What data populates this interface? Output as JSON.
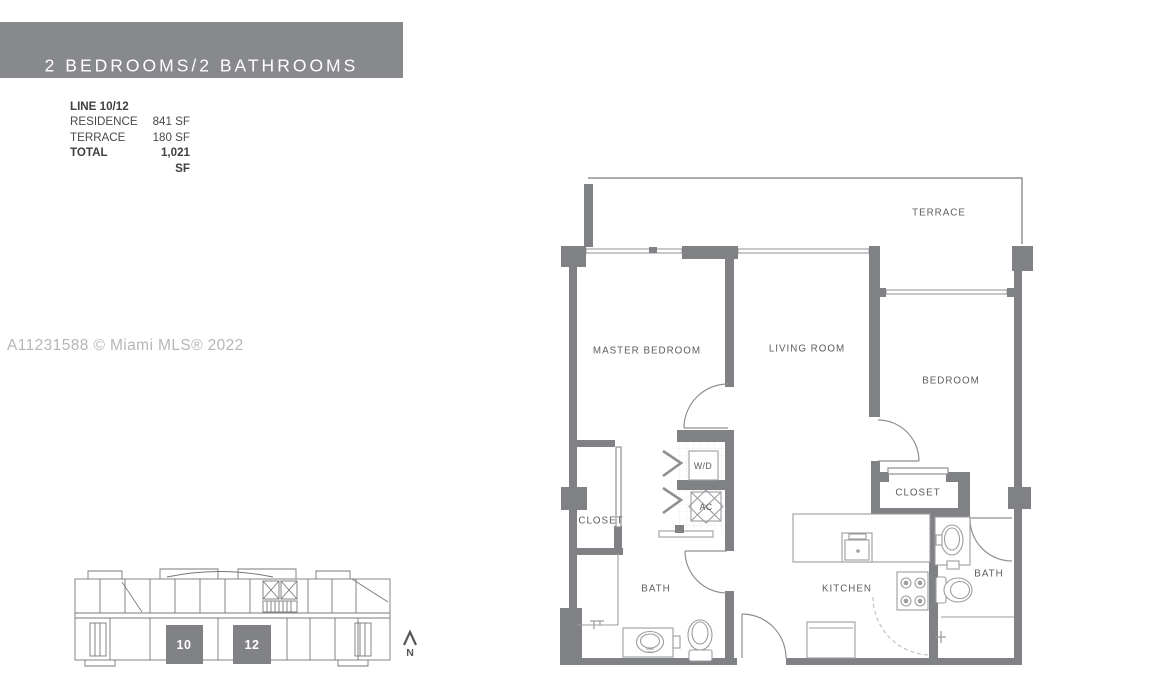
{
  "banner": {
    "title": "2 BEDROOMS/2 BATHROOMS"
  },
  "stats": {
    "line": "LINE 10/12",
    "rows": [
      {
        "label": "RESIDENCE",
        "value": "841 SF"
      },
      {
        "label": "TERRACE",
        "value": "180 SF"
      },
      {
        "label": "TOTAL",
        "value": "1,021 SF"
      }
    ]
  },
  "watermark": "A11231588 © Miami MLS® 2022",
  "floorplan": {
    "rooms": [
      {
        "id": "terrace",
        "label": "TERRACE"
      },
      {
        "id": "master-bedroom",
        "label": "MASTER BEDROOM"
      },
      {
        "id": "living-room",
        "label": "LIVING ROOM"
      },
      {
        "id": "bedroom",
        "label": "BEDROOM"
      },
      {
        "id": "master-closet",
        "label": "CLOSET"
      },
      {
        "id": "washer-dryer",
        "label": "W/D"
      },
      {
        "id": "ac-unit",
        "label": "AC"
      },
      {
        "id": "master-bath",
        "label": "BATH"
      },
      {
        "id": "bedroom-closet",
        "label": "CLOSET"
      },
      {
        "id": "kitchen",
        "label": "KITCHEN"
      },
      {
        "id": "second-bath",
        "label": "BATH"
      }
    ]
  },
  "keyplan": {
    "units": [
      {
        "label": "10"
      },
      {
        "label": "12"
      }
    ],
    "north_label": "N"
  },
  "colors": {
    "wall": "#7f8185",
    "banner_bg": "#87898c",
    "label_text": "#5c5d60",
    "watermark": "#b4b6b9",
    "keyplan_unit_fill": "#808285"
  }
}
